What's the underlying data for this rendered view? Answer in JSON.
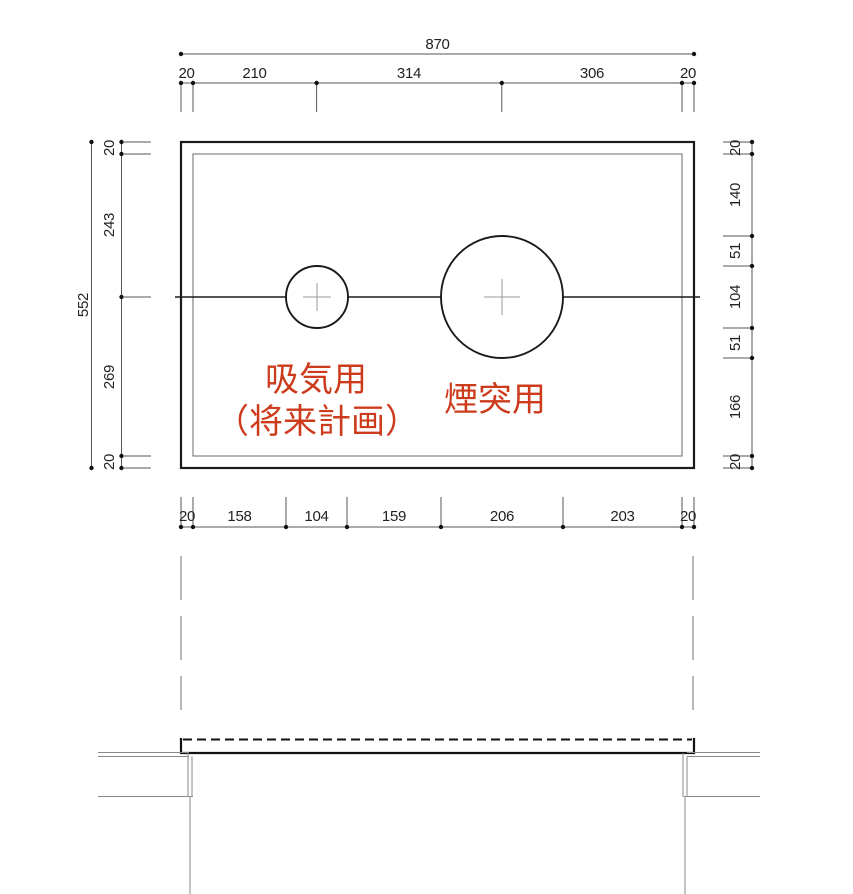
{
  "drawing": {
    "type": "slab-opening-plan-and-section",
    "colors": {
      "outline": "#1a1a1a",
      "thin_line": "#8a8a8a",
      "dimension_line": "#555555",
      "dimension_text": "#222222",
      "label_red": "#cc3b1c"
    },
    "plan_view": {
      "dim_total_width": "870",
      "dim_top_segments": [
        "20",
        "210",
        "314",
        "306",
        "20"
      ],
      "dim_total_height": "552",
      "dim_left_segments": [
        "20",
        "243",
        "269",
        "20"
      ],
      "dim_right_segments": [
        "20",
        "140",
        "51",
        "104",
        "51",
        "166",
        "20"
      ],
      "dim_bottom_segments": [
        "20",
        "158",
        "104",
        "159",
        "206",
        "203",
        "20"
      ],
      "labels": {
        "intake_title": "吸気用",
        "intake_note": "（将来計画）",
        "chimney_title": "煙突用"
      }
    }
  }
}
